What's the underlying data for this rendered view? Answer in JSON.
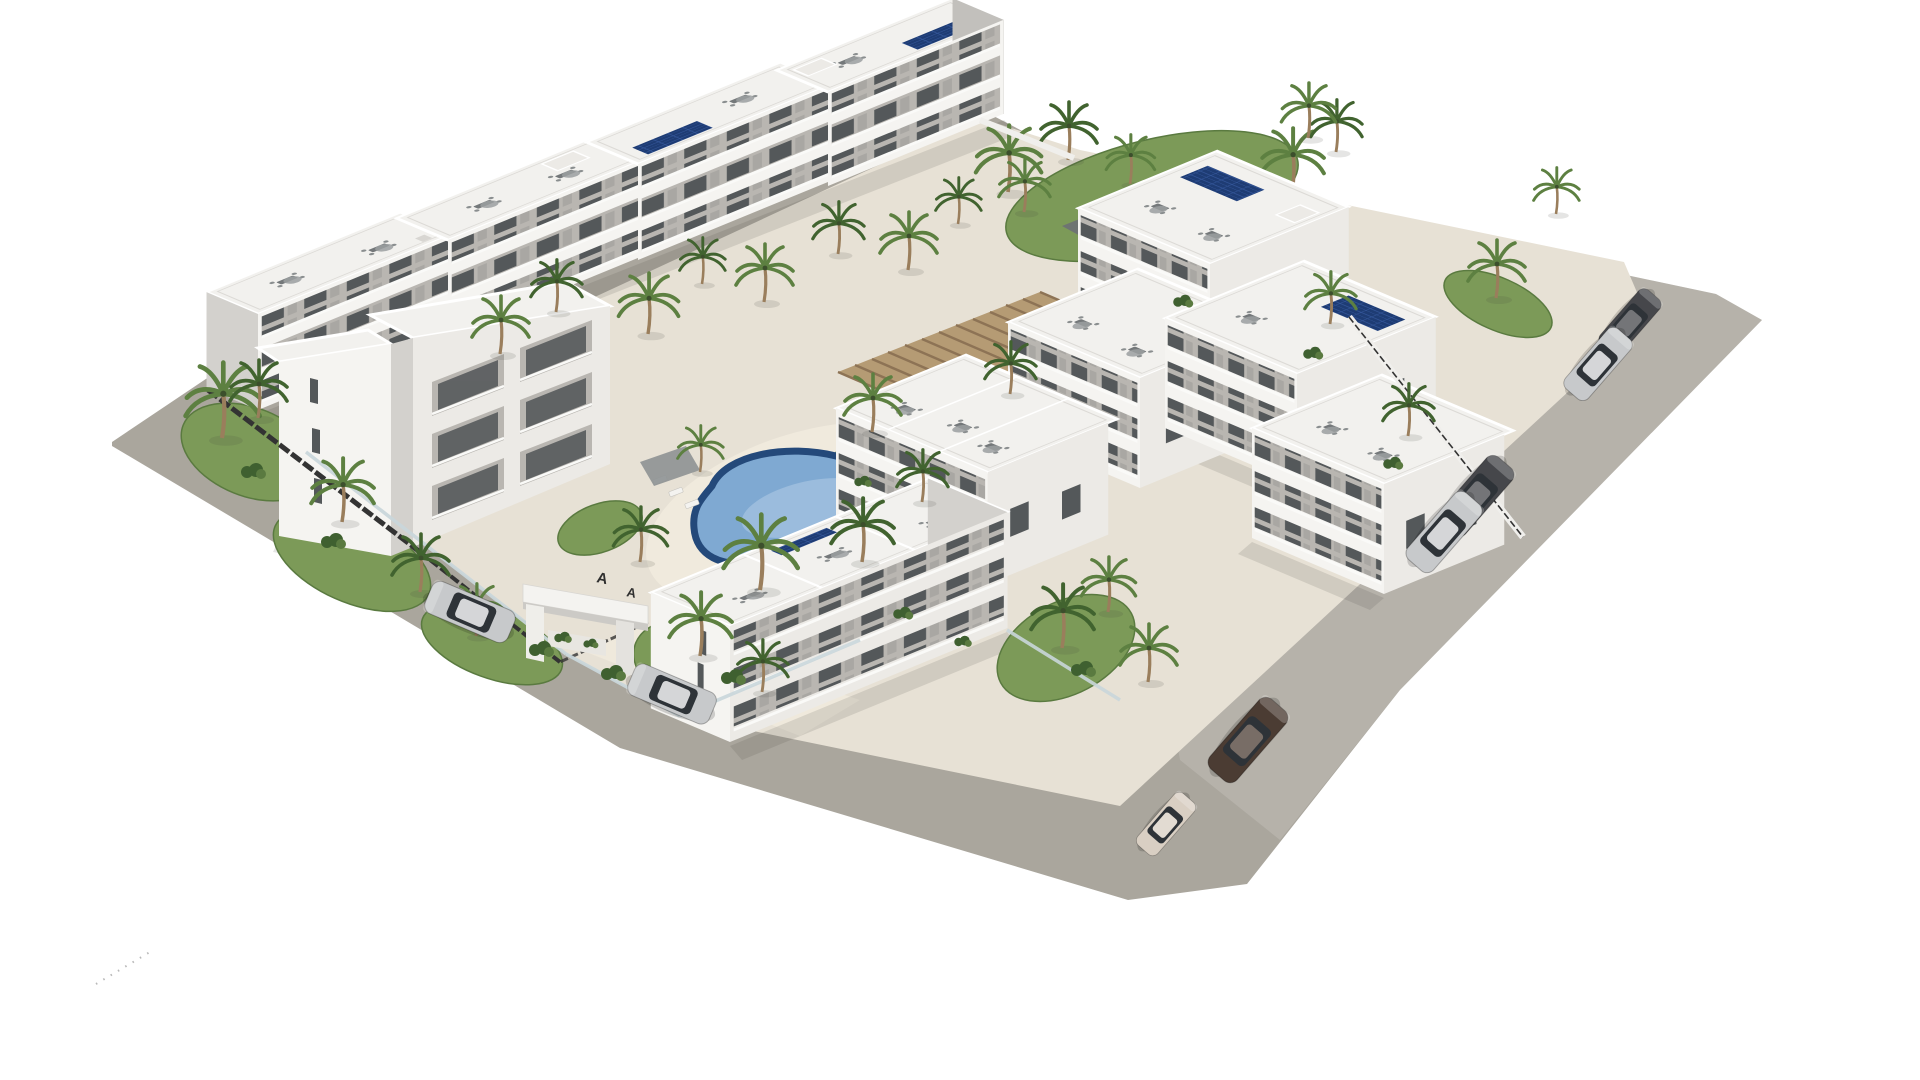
{
  "meta": {
    "description": "Aerial 3D architectural rendering of a white Mediterranean apartment complex with a central courtyard, freeform swimming pool, rectangular pool, timber pergola lounge, rooftop solariums with furniture and solar panels, palm trees, perimeter road and parked cars on a white background"
  },
  "colors": {
    "background": "#ffffff",
    "road": "#aaa69d",
    "roadLight": "#bab6ad",
    "pavement": "#e7e1d5",
    "pavementLight": "#f0eadd",
    "wallLit": "#f5f4f1",
    "wallFront": "#eceae6",
    "wallShade": "#d3d1cd",
    "wallDark": "#c2c0bc",
    "recess": "#b9b6b1",
    "glassDark": "#54585a",
    "roofTop": "#f2f1ee",
    "parapetShade": "#dcdad6",
    "poolRim": "#24497a",
    "poolWater": "#7fa9d2",
    "poolWaterLight": "#aec9e4",
    "poolRect": "#4f7fae",
    "grass": "#7c9a58",
    "grassDark": "#5a7a40",
    "bush": "#3f6030",
    "palm": "#5d8041",
    "palmDark": "#41632f",
    "trunk": "#9a7e5c",
    "pergola": "#b59b74",
    "pergolaSlat": "#8d7355",
    "deck": "#cdb896",
    "solar": "#1e3c74",
    "solarLine": "#35589c",
    "fenceDark": "#333333",
    "glassFence": "#c9d6da",
    "furniture": "#74787a",
    "shadow": "rgba(70,70,62,0.14)",
    "carSilver": "#c7c9cb",
    "carDark": "#46474b",
    "carBrown": "#4b3c33",
    "carCream": "#d9cfc3",
    "carGlass": "#2e3338",
    "sign": "#2f2f2f"
  },
  "entrance": {
    "sign_letters": [
      "A",
      "A"
    ]
  },
  "scene": {
    "buildings": [
      {
        "name": "back-row-block-1",
        "features": [
          "balconies",
          "rooftop-terrace"
        ]
      },
      {
        "name": "back-row-block-2",
        "features": [
          "balconies",
          "rooftop-terrace"
        ]
      },
      {
        "name": "back-row-block-3",
        "features": [
          "balconies",
          "rooftop-terrace",
          "solar-panels"
        ]
      },
      {
        "name": "back-row-block-4",
        "features": [
          "balconies",
          "rooftop-terrace",
          "solar-panels"
        ]
      },
      {
        "name": "front-left-tower",
        "features": [
          "slit-windows"
        ]
      },
      {
        "name": "front-left-row",
        "features": [
          "balconies",
          "rooftop-terrace"
        ]
      },
      {
        "name": "right-row-block-1",
        "features": [
          "balconies",
          "rooftop-terrace",
          "solar-panels"
        ]
      },
      {
        "name": "right-row-block-2",
        "features": [
          "balconies",
          "rooftop-terrace",
          "solar-panels"
        ]
      },
      {
        "name": "right-row-block-3",
        "features": [
          "balconies",
          "rooftop-terrace"
        ]
      },
      {
        "name": "mid-block-1",
        "features": [
          "balconies",
          "rooftop-terrace"
        ]
      },
      {
        "name": "mid-block-2",
        "features": [
          "balconies",
          "rooftop-terrace"
        ]
      },
      {
        "name": "front-block",
        "features": [
          "balconies",
          "rooftop-terrace",
          "slit-windows"
        ]
      }
    ],
    "pools": [
      {
        "name": "central-freeform-pool",
        "shape": "kidney"
      },
      {
        "name": "north-rectangular-pool",
        "shape": "rectangular"
      }
    ],
    "structures": [
      {
        "name": "timber-pergola-lounge"
      },
      {
        "name": "entrance-portal"
      }
    ],
    "cars": [
      {
        "name": "silver-suv",
        "area": "left-road"
      },
      {
        "name": "silver-sedan",
        "area": "left-road"
      },
      {
        "name": "dark-hatchback",
        "area": "right-road-top"
      },
      {
        "name": "silver-car",
        "area": "right-road-top"
      },
      {
        "name": "dark-gray-sedan",
        "area": "right-road"
      },
      {
        "name": "silver-sedan",
        "area": "right-road"
      },
      {
        "name": "brown-estate",
        "area": "right-road-bottom"
      },
      {
        "name": "cream-city-car",
        "area": "bottom-road"
      }
    ],
    "vegetation": {
      "palm_trees": 36,
      "lawn_patches": 12,
      "bushes": 12
    }
  }
}
